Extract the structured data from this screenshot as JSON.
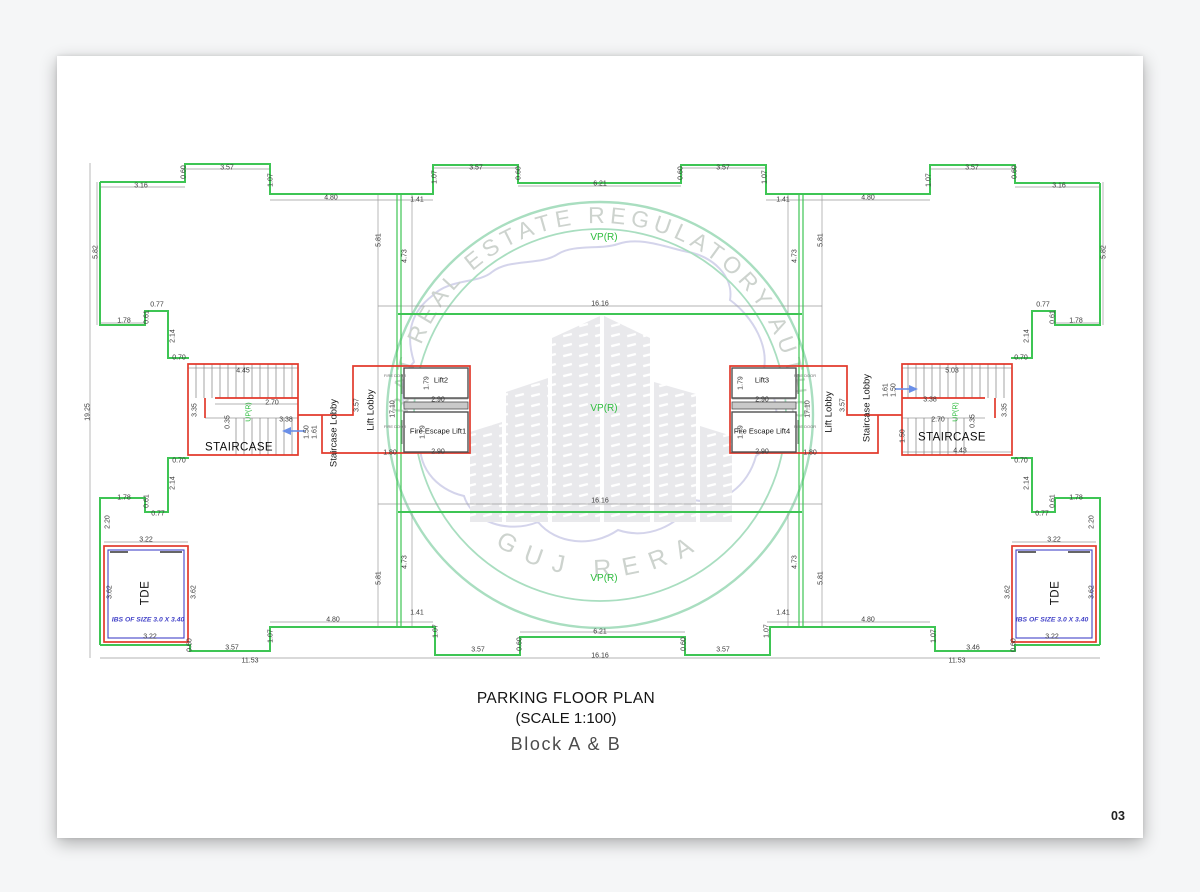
{
  "sheet": {
    "page_number": "03"
  },
  "title_block": {
    "line1": "PARKING FLOOR PLAN",
    "line2": "(SCALE 1:100)",
    "line3": "Block A & B"
  },
  "watermark": {
    "arc_text": "GUJARAT REAL ESTATE REGULATORY AUTHORITY",
    "bottom_arc_text": "GUJ RERA"
  },
  "colors": {
    "wall_green": "#3ec554",
    "stair_red": "#e23a2c",
    "tde_blue": "#4343c8",
    "arrow_blue": "#6a8fe8",
    "label_green": "#2fbd3f",
    "seal_green": "#a9dec0",
    "seal_text": "#cdd3ce",
    "map_purple": "#c9c9e6"
  },
  "plan": {
    "labels": [
      {
        "t": "3.16",
        "x": 141,
        "y": 186
      },
      {
        "t": "0.60",
        "x": 184,
        "y": 172,
        "r": 1
      },
      {
        "t": "3.57",
        "x": 227,
        "y": 168
      },
      {
        "t": "1.07",
        "x": 271,
        "y": 180,
        "r": 1
      },
      {
        "t": "4.80",
        "x": 331,
        "y": 198
      },
      {
        "t": "1.41",
        "x": 417,
        "y": 200
      },
      {
        "t": "1.07",
        "x": 435,
        "y": 177,
        "r": 1
      },
      {
        "t": "3.57",
        "x": 476,
        "y": 168
      },
      {
        "t": "0.60",
        "x": 519,
        "y": 173,
        "r": 1
      },
      {
        "t": "6.21",
        "x": 600,
        "y": 184
      },
      {
        "t": "0.60",
        "x": 681,
        "y": 173,
        "r": 1
      },
      {
        "t": "3.57",
        "x": 723,
        "y": 168
      },
      {
        "t": "1.07",
        "x": 765,
        "y": 177,
        "r": 1
      },
      {
        "t": "1.41",
        "x": 783,
        "y": 200
      },
      {
        "t": "4.80",
        "x": 868,
        "y": 198
      },
      {
        "t": "1.07",
        "x": 929,
        "y": 180,
        "r": 1
      },
      {
        "t": "3.57",
        "x": 972,
        "y": 168
      },
      {
        "t": "0.60",
        "x": 1015,
        "y": 172,
        "r": 1
      },
      {
        "t": "3.16",
        "x": 1059,
        "y": 186
      },
      {
        "t": "5.82",
        "x": 96,
        "y": 252,
        "r": 1
      },
      {
        "t": "19.25",
        "x": 88,
        "y": 412,
        "r": 1
      },
      {
        "t": "1.78",
        "x": 124,
        "y": 321
      },
      {
        "t": "0.61",
        "x": 147,
        "y": 317,
        "r": 1
      },
      {
        "t": "0.77",
        "x": 157,
        "y": 305
      },
      {
        "t": "2.14",
        "x": 173,
        "y": 336,
        "r": 1
      },
      {
        "t": "0.70",
        "x": 179,
        "y": 358
      },
      {
        "t": "3.35",
        "x": 195,
        "y": 410,
        "r": 1
      },
      {
        "t": "0.70",
        "x": 179,
        "y": 461
      },
      {
        "t": "2.14",
        "x": 173,
        "y": 483,
        "r": 1
      },
      {
        "t": "1.78",
        "x": 124,
        "y": 498
      },
      {
        "t": "0.61",
        "x": 147,
        "y": 501,
        "r": 1
      },
      {
        "t": "0.77",
        "x": 158,
        "y": 514
      },
      {
        "t": "2.20",
        "x": 108,
        "y": 522,
        "r": 1
      },
      {
        "t": "5.82",
        "x": 1104,
        "y": 252,
        "r": 1
      },
      {
        "t": "1.78",
        "x": 1076,
        "y": 321
      },
      {
        "t": "0.61",
        "x": 1053,
        "y": 317,
        "r": 1
      },
      {
        "t": "0.77",
        "x": 1043,
        "y": 305
      },
      {
        "t": "2.14",
        "x": 1027,
        "y": 336,
        "r": 1
      },
      {
        "t": "0.70",
        "x": 1021,
        "y": 358
      },
      {
        "t": "3.35",
        "x": 1005,
        "y": 410,
        "r": 1
      },
      {
        "t": "0.70",
        "x": 1021,
        "y": 461
      },
      {
        "t": "2.14",
        "x": 1027,
        "y": 483,
        "r": 1
      },
      {
        "t": "1.78",
        "x": 1076,
        "y": 498
      },
      {
        "t": "0.61",
        "x": 1053,
        "y": 501,
        "r": 1
      },
      {
        "t": "0.77",
        "x": 1042,
        "y": 514
      },
      {
        "t": "2.20",
        "x": 1092,
        "y": 522,
        "r": 1
      },
      {
        "t": "4.45",
        "x": 243,
        "y": 371
      },
      {
        "t": "2.70",
        "x": 272,
        "y": 403
      },
      {
        "t": "3.38",
        "x": 286,
        "y": 420
      },
      {
        "t": "0.35",
        "x": 228,
        "y": 422,
        "r": 1
      },
      {
        "t": "STAIRCASE",
        "x": 239,
        "y": 448,
        "k": "room"
      },
      {
        "t": "UP(R)",
        "x": 249,
        "y": 412,
        "r": 1,
        "k": "up"
      },
      {
        "t": "1.50",
        "x": 307,
        "y": 432,
        "r": 1
      },
      {
        "t": "1.61",
        "x": 315,
        "y": 432,
        "r": 1
      },
      {
        "t": "5.03",
        "x": 952,
        "y": 371
      },
      {
        "t": "3.38",
        "x": 930,
        "y": 400
      },
      {
        "t": "2.70",
        "x": 938,
        "y": 420
      },
      {
        "t": "0.35",
        "x": 973,
        "y": 421,
        "r": 1
      },
      {
        "t": "1.50",
        "x": 903,
        "y": 436,
        "r": 1
      },
      {
        "t": "4.43",
        "x": 960,
        "y": 451
      },
      {
        "t": "STAIRCASE",
        "x": 952,
        "y": 438,
        "k": "room"
      },
      {
        "t": "UP(R)",
        "x": 956,
        "y": 412,
        "r": 1,
        "k": "up"
      },
      {
        "t": "1.61",
        "x": 886,
        "y": 390,
        "r": 1
      },
      {
        "t": "1.50",
        "x": 894,
        "y": 390,
        "r": 1
      },
      {
        "t": "Staircase Lobby",
        "x": 334,
        "y": 433,
        "r": 1,
        "k": "lobby"
      },
      {
        "t": "Lift Lobby",
        "x": 371,
        "y": 410,
        "r": 1,
        "k": "lobby"
      },
      {
        "t": "3.57",
        "x": 357,
        "y": 405,
        "r": 1
      },
      {
        "t": "17.10",
        "x": 393,
        "y": 409,
        "r": 1
      },
      {
        "t": "1.80",
        "x": 390,
        "y": 453
      },
      {
        "t": "FIRE DOOR",
        "x": 395,
        "y": 376,
        "k": "fd"
      },
      {
        "t": "FIRE DOOR",
        "x": 395,
        "y": 427,
        "k": "fd"
      },
      {
        "t": "Lift2",
        "x": 441,
        "y": 380,
        "k": "lift"
      },
      {
        "t": "1.79",
        "x": 427,
        "y": 383,
        "r": 1
      },
      {
        "t": "2.90",
        "x": 438,
        "y": 400
      },
      {
        "t": "Fire Escape Lift1",
        "x": 438,
        "y": 431,
        "k": "lift"
      },
      {
        "t": "1.79",
        "x": 423,
        "y": 432,
        "r": 1
      },
      {
        "t": "2.90",
        "x": 438,
        "y": 452
      },
      {
        "t": "Staircase Lobby",
        "x": 867,
        "y": 408,
        "r": 1,
        "k": "lobby"
      },
      {
        "t": "Lift Lobby",
        "x": 829,
        "y": 412,
        "r": 1,
        "k": "lobby"
      },
      {
        "t": "3.57",
        "x": 843,
        "y": 405,
        "r": 1
      },
      {
        "t": "17.10",
        "x": 808,
        "y": 409,
        "r": 1
      },
      {
        "t": "1.80",
        "x": 810,
        "y": 453
      },
      {
        "t": "FIRE DOOR",
        "x": 805,
        "y": 376,
        "k": "fd"
      },
      {
        "t": "FIRE DOOR",
        "x": 805,
        "y": 427,
        "k": "fd"
      },
      {
        "t": "Lift3",
        "x": 762,
        "y": 380,
        "k": "lift"
      },
      {
        "t": "1.79",
        "x": 741,
        "y": 383,
        "r": 1
      },
      {
        "t": "2.90",
        "x": 762,
        "y": 400
      },
      {
        "t": "Fire Escape Lift4",
        "x": 762,
        "y": 431,
        "k": "lift"
      },
      {
        "t": "1.79",
        "x": 741,
        "y": 432,
        "r": 1
      },
      {
        "t": "2.90",
        "x": 762,
        "y": 452
      },
      {
        "t": "VP(R)",
        "x": 604,
        "y": 238,
        "k": "vp"
      },
      {
        "t": "VP(R)",
        "x": 604,
        "y": 409,
        "k": "vp"
      },
      {
        "t": "VP(R)",
        "x": 604,
        "y": 579,
        "k": "vp"
      },
      {
        "t": "16.16",
        "x": 600,
        "y": 304
      },
      {
        "t": "16.16",
        "x": 600,
        "y": 501
      },
      {
        "t": "16.16",
        "x": 600,
        "y": 656
      },
      {
        "t": "4.73",
        "x": 405,
        "y": 256,
        "r": 1
      },
      {
        "t": "5.81",
        "x": 379,
        "y": 240,
        "r": 1
      },
      {
        "t": "4.73",
        "x": 405,
        "y": 562,
        "r": 1
      },
      {
        "t": "5.81",
        "x": 379,
        "y": 578,
        "r": 1
      },
      {
        "t": "4.73",
        "x": 795,
        "y": 256,
        "r": 1
      },
      {
        "t": "5.81",
        "x": 821,
        "y": 240,
        "r": 1
      },
      {
        "t": "4.73",
        "x": 795,
        "y": 562,
        "r": 1
      },
      {
        "t": "5.81",
        "x": 821,
        "y": 578,
        "r": 1
      },
      {
        "t": "3.22",
        "x": 146,
        "y": 540
      },
      {
        "t": "3.62",
        "x": 110,
        "y": 592,
        "r": 1
      },
      {
        "t": "3.62",
        "x": 194,
        "y": 592,
        "r": 1
      },
      {
        "t": "TDE",
        "x": 146,
        "y": 593,
        "r": 1,
        "k": "tde"
      },
      {
        "t": "IBS OF SIZE 3.0 X 3.40",
        "x": 148,
        "y": 621,
        "k": "ibs"
      },
      {
        "t": "3.22",
        "x": 150,
        "y": 637
      },
      {
        "t": "0.60",
        "x": 190,
        "y": 645,
        "r": 1
      },
      {
        "t": "3.57",
        "x": 232,
        "y": 648
      },
      {
        "t": "1.07",
        "x": 271,
        "y": 636,
        "r": 1
      },
      {
        "t": "4.80",
        "x": 333,
        "y": 620
      },
      {
        "t": "11.53",
        "x": 250,
        "y": 661
      },
      {
        "t": "1.41",
        "x": 417,
        "y": 613
      },
      {
        "t": "1.07",
        "x": 436,
        "y": 631,
        "r": 1
      },
      {
        "t": "3.57",
        "x": 478,
        "y": 650
      },
      {
        "t": "0.60",
        "x": 520,
        "y": 644,
        "r": 1
      },
      {
        "t": "6.21",
        "x": 600,
        "y": 632
      },
      {
        "t": "0.60",
        "x": 684,
        "y": 644,
        "r": 1
      },
      {
        "t": "3.57",
        "x": 723,
        "y": 650
      },
      {
        "t": "1.07",
        "x": 767,
        "y": 631,
        "r": 1
      },
      {
        "t": "1.41",
        "x": 783,
        "y": 613
      },
      {
        "t": "4.80",
        "x": 868,
        "y": 620
      },
      {
        "t": "1.07",
        "x": 934,
        "y": 636,
        "r": 1
      },
      {
        "t": "3.46",
        "x": 973,
        "y": 648
      },
      {
        "t": "0.60",
        "x": 1014,
        "y": 645,
        "r": 1
      },
      {
        "t": "11.53",
        "x": 957,
        "y": 661
      },
      {
        "t": "3.22",
        "x": 1054,
        "y": 540
      },
      {
        "t": "3.62",
        "x": 1008,
        "y": 592,
        "r": 1
      },
      {
        "t": "3.62",
        "x": 1092,
        "y": 592,
        "r": 1
      },
      {
        "t": "TDE",
        "x": 1056,
        "y": 593,
        "r": 1,
        "k": "tde"
      },
      {
        "t": "IBS OF SIZE 3.0 X 3.40",
        "x": 1052,
        "y": 621,
        "k": "ibs"
      },
      {
        "t": "3.22",
        "x": 1052,
        "y": 637
      }
    ]
  }
}
